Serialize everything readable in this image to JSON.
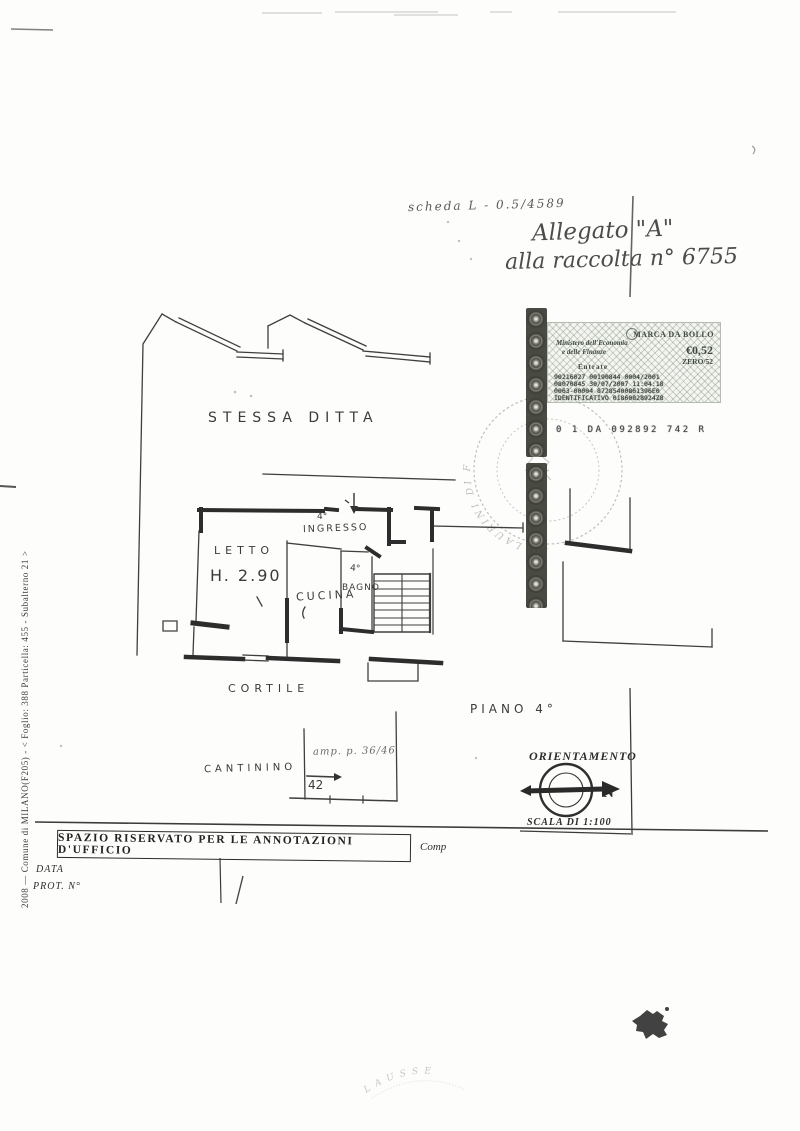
{
  "colors": {
    "paper": "#fdfdfb",
    "ink": "#333333",
    "stamp_ink": "#3f4a40",
    "seal_dark": "#34352e"
  },
  "handwritten": {
    "scheda_note": "scheda   L - 0.5/4589",
    "allegato_line1": "Allegato \"A\"",
    "allegato_line2": "alla raccolta n° 6755"
  },
  "revenue_stamp": {
    "title": "MARCA DA BOLLO",
    "ministry_line1": "Ministero dell'Economia",
    "ministry_line2": "e delle Finanze",
    "agency": "Entrate",
    "amount": "€0,52",
    "amount_words": "ZERO/52",
    "code_rows": [
      "90216027   00190844   0004/2001",
      "08070845   30/07/2007  11:04:18",
      "0063-00004  87285400861396E0",
      "IDENTIFICATIVO  01860828924Z8"
    ],
    "serial": "0 1 DA 092892 742 R"
  },
  "seals": {
    "notary_arc_text": "PO LAURINI DI F",
    "faint_arc_text": "LAUSSE"
  },
  "plan": {
    "area_label": "STESSA  DITTA",
    "letto": "LETTO",
    "height_note": "H. 2.90",
    "cucina": "CUCINA",
    "ingresso_floor": "4°",
    "ingresso": "INGRESSO",
    "bagno_floor": "4°",
    "bagno": "BAGNO",
    "cortile": "CORTILE",
    "cantina": "CANTININO",
    "cantina_note": "amp. p. 36/46",
    "cantina_number": "42",
    "piano": "PIANO  4°"
  },
  "orientation": {
    "title": "ORIENTAMENTO",
    "north": "N",
    "scale": "SCALA DI 1:100"
  },
  "footer": {
    "annotations_title": "SPAZIO RISERVATO PER LE ANNOTAZIONI D'UFFICIO",
    "comp": "Comp",
    "data_label": "DATA",
    "prot_label": "PROT. N°"
  },
  "margin_text": "2008 — Comune di MILANO(F205) - < Foglio: 388 Particella: 455 - Subalterno 21 >"
}
